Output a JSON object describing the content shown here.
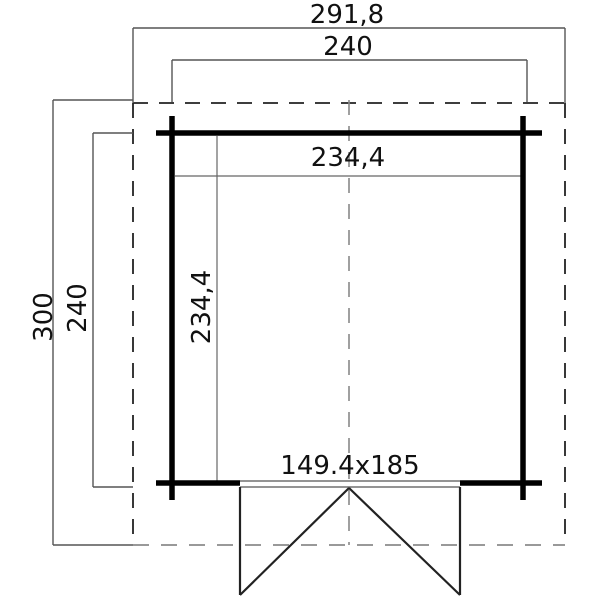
{
  "diagram": {
    "kind": "cabin-floor-plan",
    "labels": {
      "overall_width": "291,8",
      "body_width": "240",
      "overall_depth": "300",
      "body_depth": "240",
      "inner_width": "234,4",
      "inner_depth": "234,4",
      "door_size": "149.4x185"
    },
    "colors": {
      "background": "#ffffff",
      "wall": "#000000",
      "dimension_line": "#555555",
      "interior_line": "#666666",
      "overhang_dash_dark": "#222222",
      "overhang_dash_gray": "#999999",
      "centerline_dash": "#888888",
      "door_line": "#222222",
      "text": "#111111"
    }
  }
}
